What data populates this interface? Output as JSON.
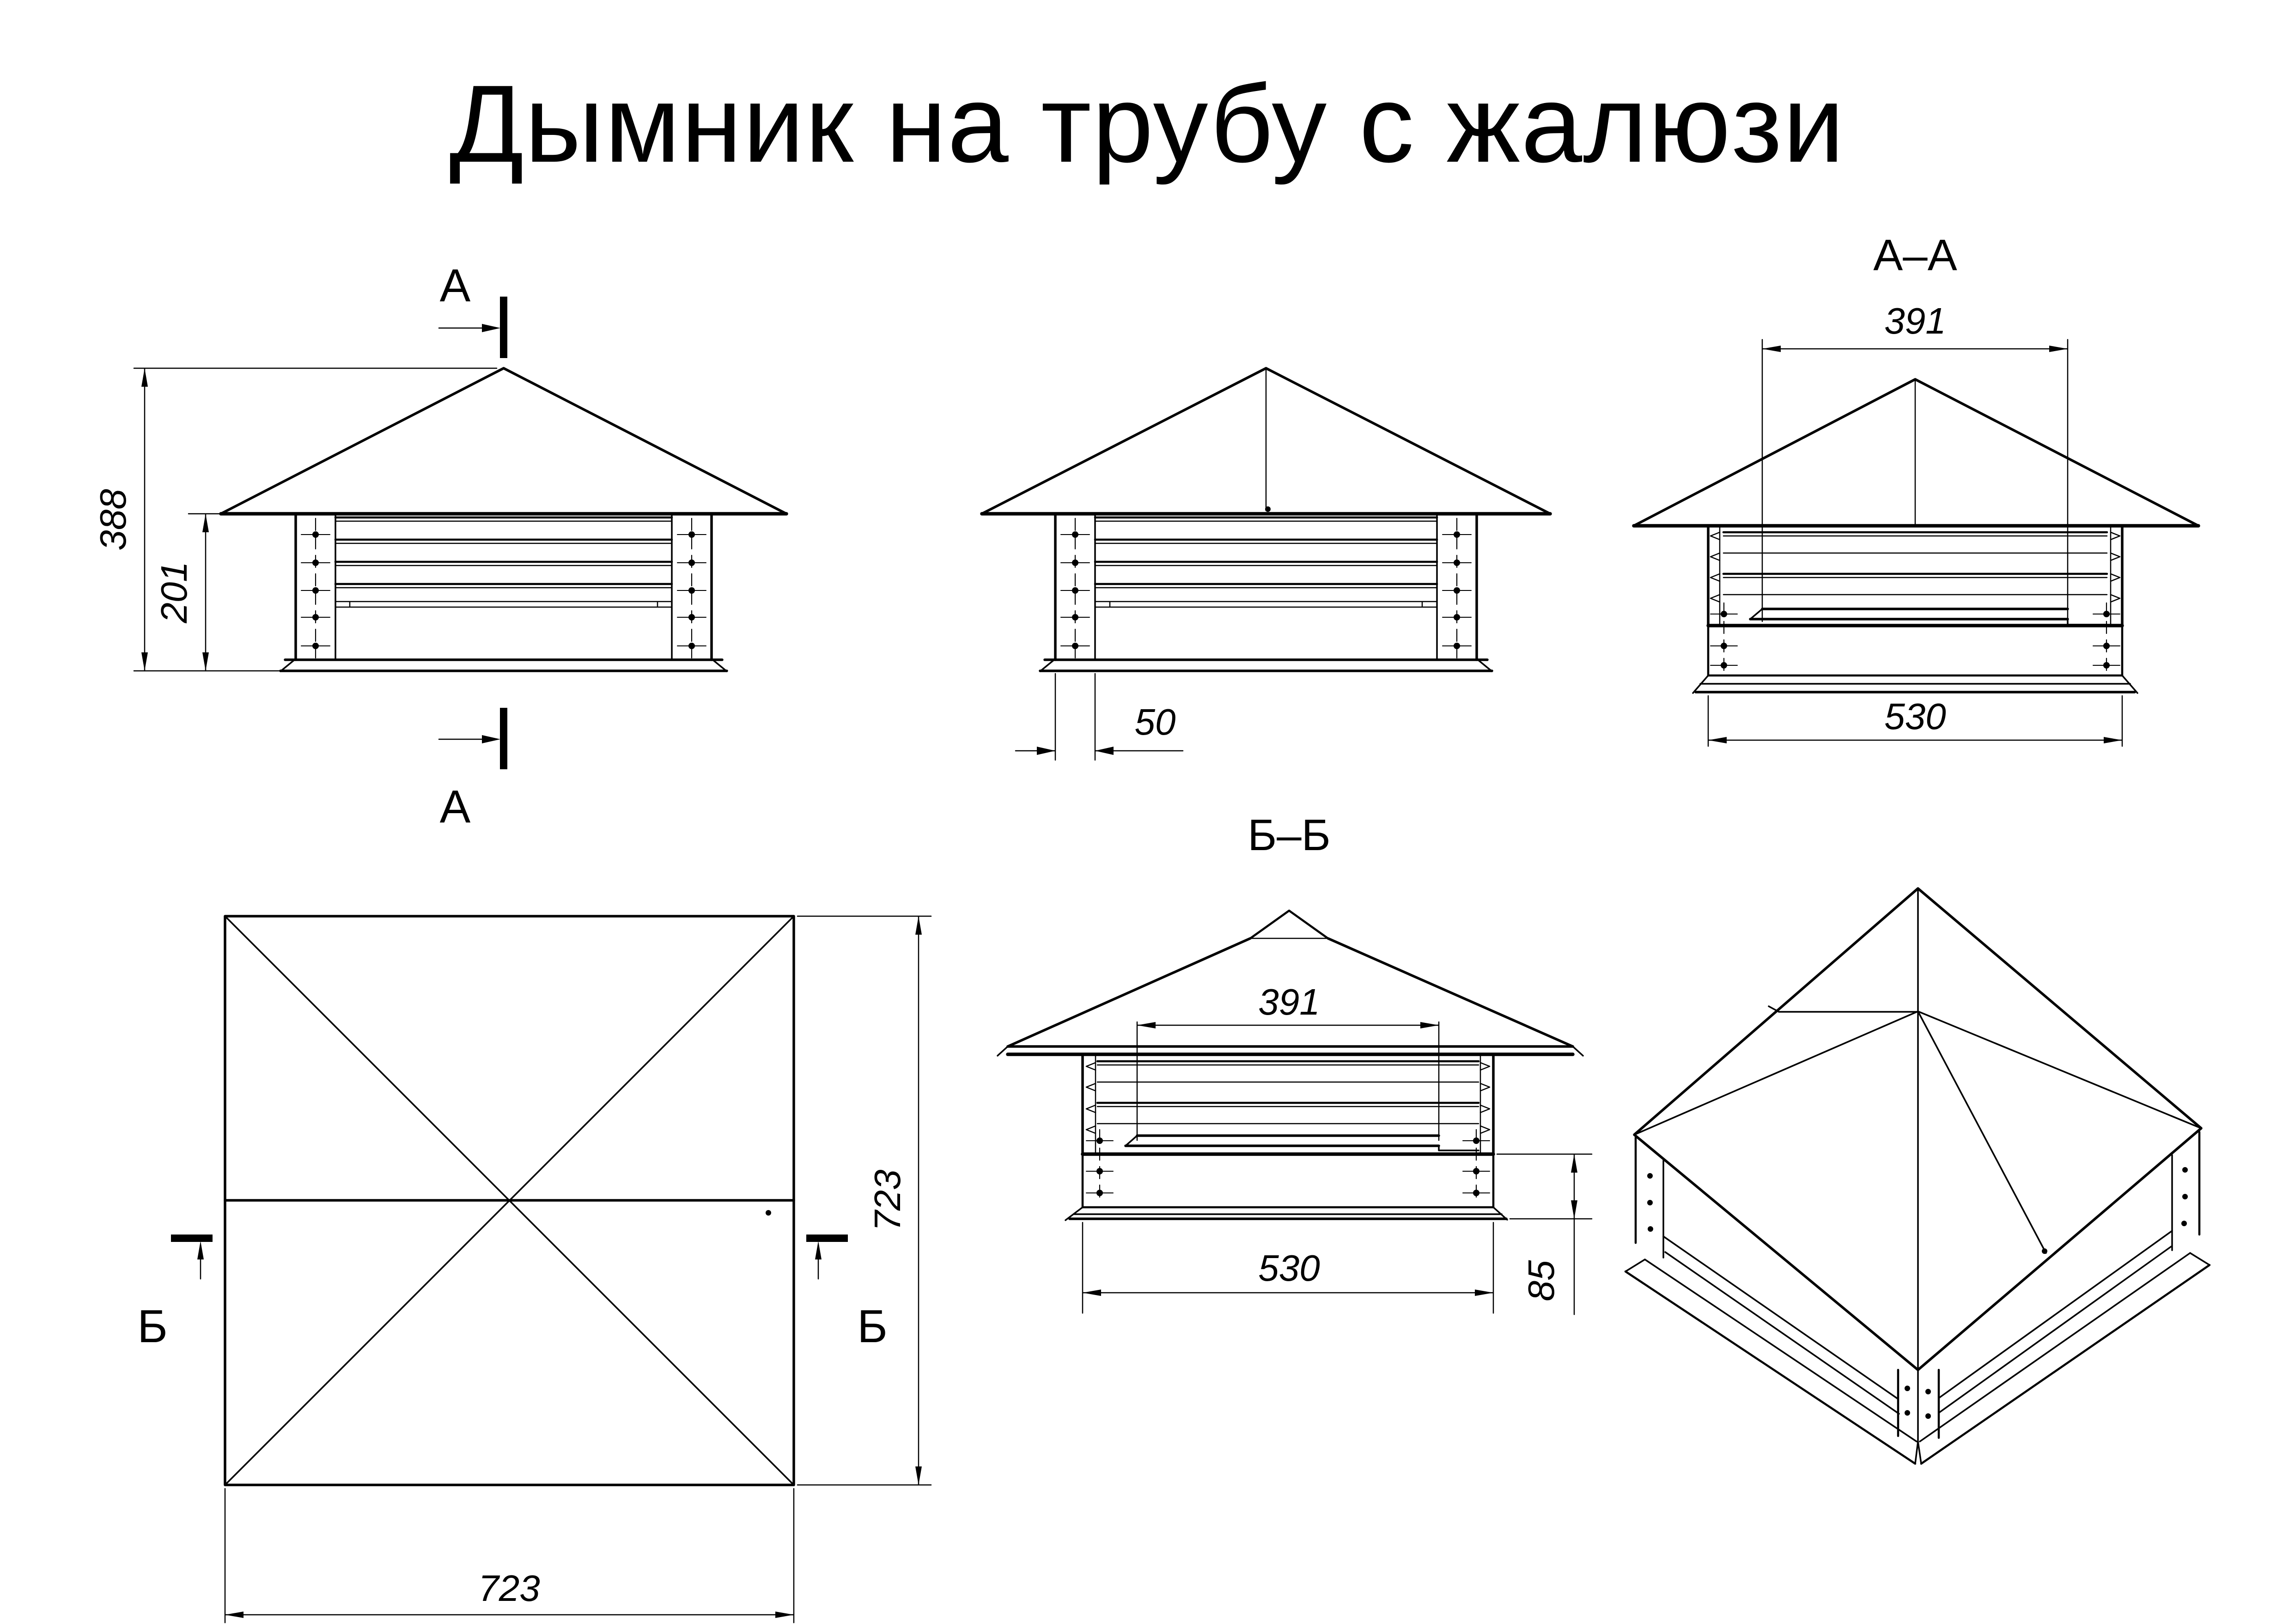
{
  "title": "Дымник на трубу с жалюзи",
  "views": {
    "front": {
      "section_label_top": "А",
      "section_label_bottom": "А",
      "dim_total_height": "388",
      "dim_body_height": "201"
    },
    "side": {
      "dim_column_width": "50"
    },
    "section_aa": {
      "title": "А–А",
      "dim_inner_width": "391",
      "dim_outer_width": "530"
    },
    "plan": {
      "section_label_left": "Б",
      "section_label_right": "Б",
      "dim_width": "723",
      "dim_height": "723"
    },
    "section_bb": {
      "title": "Б–Б",
      "dim_inner_width": "391",
      "dim_outer_width": "530",
      "dim_flange_height": "85"
    }
  }
}
